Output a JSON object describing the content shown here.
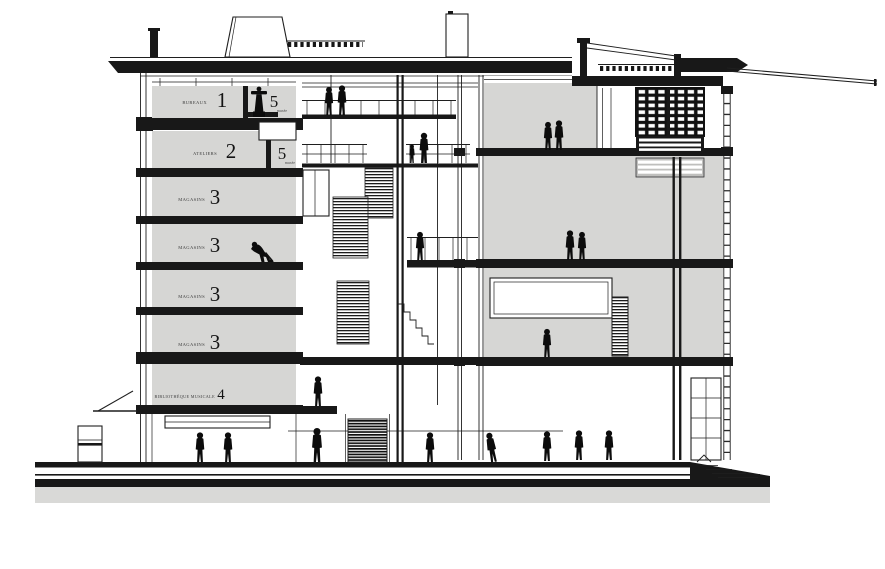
{
  "floors": [
    {
      "num": "1",
      "label": "BUREAUX"
    },
    {
      "num": "2",
      "label": "ATELIERS"
    },
    {
      "num": "3",
      "label": "MAGASINS"
    },
    {
      "num": "3",
      "label": "MAGASINS"
    },
    {
      "num": "3",
      "label": "MAGASINS"
    },
    {
      "num": "3",
      "label": "MAGASINS"
    },
    {
      "num": "4",
      "label": "BIBLIOTHÈQUE MUSICALE"
    },
    {
      "num": "5",
      "label": "musée"
    },
    {
      "num": "5",
      "label": "musée"
    }
  ],
  "colors": {
    "line": "#1f1f1f",
    "room_fill": "#d6d6d4",
    "ground_fill": "#d9d9d7",
    "background": "#ffffff"
  }
}
